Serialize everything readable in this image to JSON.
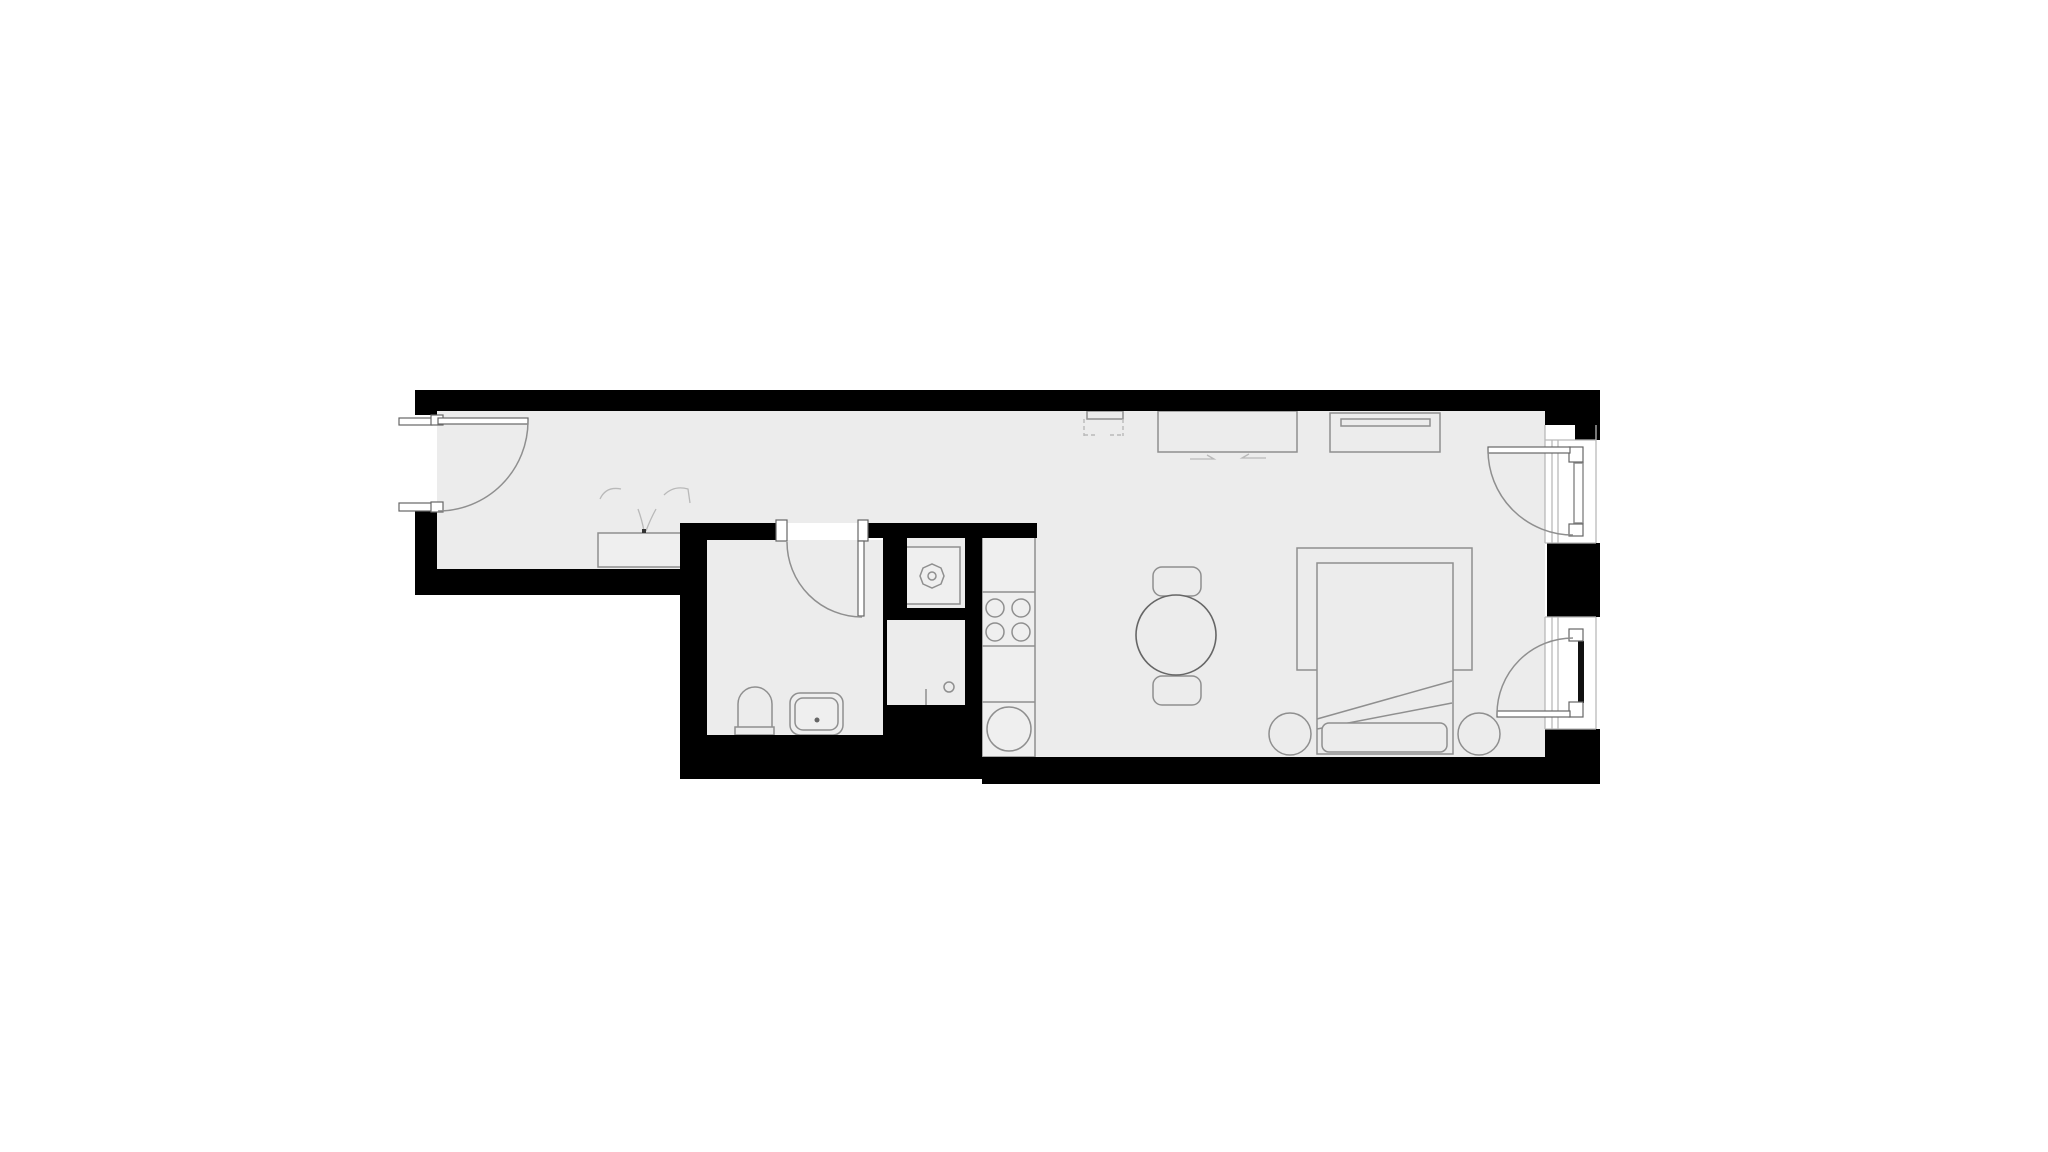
{
  "canvas": {
    "width": 2048,
    "height": 1152
  },
  "colors": {
    "background": "#ffffff",
    "wall": "#000000",
    "floor": "#ececec",
    "fixture_fill": "#efefef",
    "line": "#8f8f8f",
    "line_dark": "#666666",
    "line_light": "#b9b9b9",
    "sash": "#111111",
    "white": "#ffffff"
  },
  "floorplan": {
    "type": "studio-apartment-floor-plan",
    "rooms": [
      {
        "name": "entry-hallway"
      },
      {
        "name": "bathroom"
      },
      {
        "name": "shower"
      },
      {
        "name": "kitchen"
      },
      {
        "name": "living-sleeping-room"
      }
    ],
    "fixtures": [
      "entrance-door",
      "wardrobe-double-doors",
      "bathroom-door",
      "toilet",
      "washbasin",
      "shower-drain",
      "washing-machine",
      "kitchen-counter",
      "cooktop",
      "round-kitchen-sink",
      "dining-table",
      "dining-chair",
      "dining-chair",
      "wall-unit-dashed",
      "desk-sideboard",
      "dresser-with-slot",
      "bed",
      "pillow",
      "rug",
      "round-stool",
      "round-stool",
      "balcony-door-upper",
      "balcony-door-lower",
      "window-upper",
      "window-lower"
    ],
    "counts": {
      "cooktop_burners": 4,
      "dining_chairs": 2,
      "stools": 2,
      "balcony_doors": 2,
      "windows": 2
    }
  }
}
